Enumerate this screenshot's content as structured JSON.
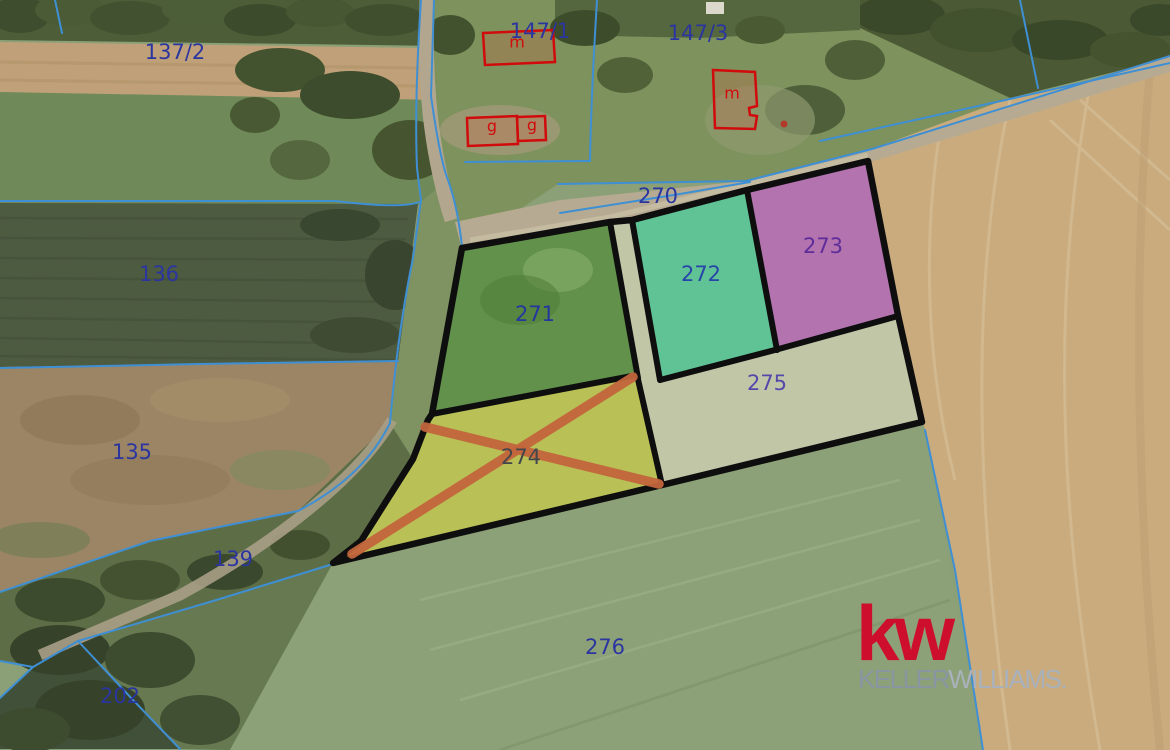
{
  "map": {
    "parcel_labels": [
      {
        "text": "137/2",
        "x": 175,
        "y": 52,
        "color": "#2b35a0"
      },
      {
        "text": "147/1",
        "x": 540,
        "y": 31,
        "color": "#2b35a0"
      },
      {
        "text": "147/3",
        "x": 698,
        "y": 33,
        "color": "#2b35a0"
      },
      {
        "text": "270",
        "x": 658,
        "y": 196,
        "color": "#2b35a0"
      },
      {
        "text": "136",
        "x": 159,
        "y": 274,
        "color": "#2b35a0"
      },
      {
        "text": "271",
        "x": 535,
        "y": 314,
        "color": "#23379e"
      },
      {
        "text": "272",
        "x": 701,
        "y": 274,
        "color": "#2745a8"
      },
      {
        "text": "273",
        "x": 823,
        "y": 246,
        "color": "#5e2d99"
      },
      {
        "text": "275",
        "x": 767,
        "y": 383,
        "color": "#5548ab"
      },
      {
        "text": "135",
        "x": 132,
        "y": 452,
        "color": "#2b35a0"
      },
      {
        "text": "274",
        "x": 521,
        "y": 457,
        "color": "#43464a"
      },
      {
        "text": "139",
        "x": 233,
        "y": 559,
        "color": "#2b35a0"
      },
      {
        "text": "276",
        "x": 605,
        "y": 647,
        "color": "#2b35a0"
      },
      {
        "text": "202",
        "x": 120,
        "y": 696,
        "color": "#2b35a0"
      }
    ],
    "building_labels": [
      {
        "text": "m",
        "x": 517,
        "y": 42
      },
      {
        "text": "g",
        "x": 492,
        "y": 126
      },
      {
        "text": "g",
        "x": 532,
        "y": 125
      },
      {
        "text": "m",
        "x": 732,
        "y": 93
      }
    ],
    "colors": {
      "cadastral_line": "#3f8fd4",
      "selection_outline": "#0e0e0e",
      "building_outline": "#d10b0b",
      "overlay_green": "#37821f",
      "overlay_teal": "#55cd9e",
      "overlay_magenta": "#c55fc8",
      "overlay_yellow": "#e0da3a",
      "overlay_beige": "#e6dfc8",
      "cross_orange": "#c2653c",
      "kw_red": "#ce0e2d",
      "kw_gray_dark": "#8a95a2",
      "kw_gray_light": "#a9b2bc"
    }
  },
  "watermark": {
    "kw": "kw",
    "keller": "KELLER",
    "williams": "WILLIAMS",
    "dot": "."
  }
}
